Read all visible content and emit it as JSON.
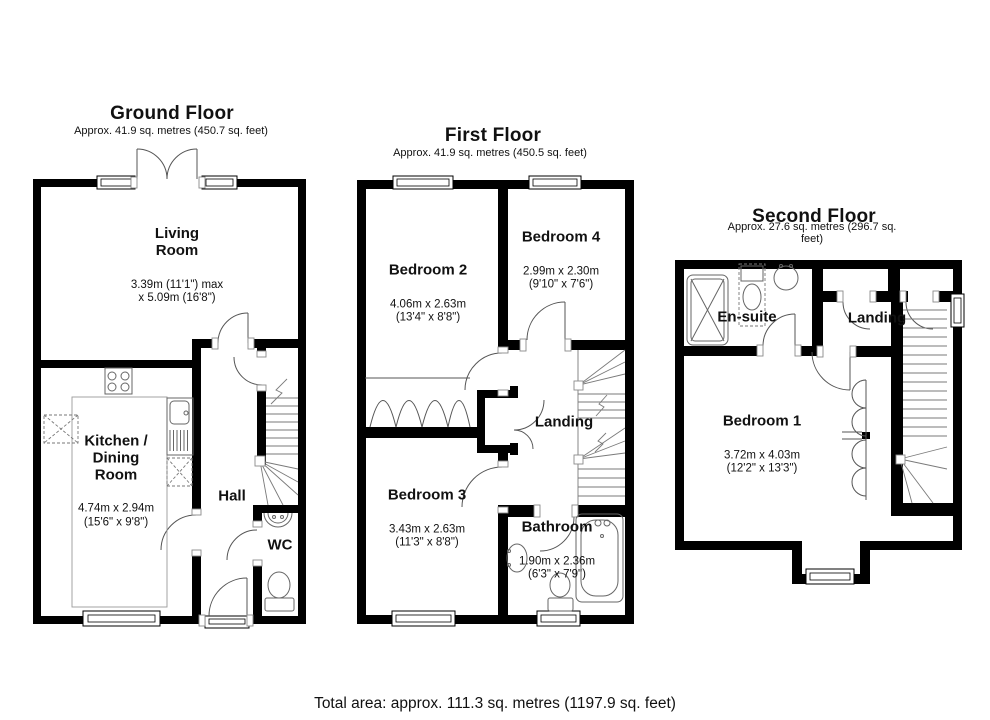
{
  "footer": {
    "total_area": "Total area: approx. 111.3 sq. metres (1197.9 sq. feet)"
  },
  "colors": {
    "wall": "#000000",
    "door_line": "#555555",
    "fixture_line": "#666666",
    "text": "#111111",
    "background": "#ffffff"
  },
  "floors": {
    "ground": {
      "title": "Ground Floor",
      "subtitle": "Approx. 41.9 sq. metres (450.7 sq. feet)",
      "rooms": {
        "living": {
          "name": "Living\nRoom",
          "dims": "3.39m (11'1\") max\nx 5.09m (16'8\")"
        },
        "kitchen": {
          "name": "Kitchen /\nDining\nRoom",
          "dims": "4.74m x 2.94m\n(15'6\" x 9'8\")"
        },
        "hall": {
          "name": "Hall"
        },
        "wc": {
          "name": "WC"
        }
      }
    },
    "first": {
      "title": "First Floor",
      "subtitle": "Approx. 41.9 sq. metres (450.5 sq. feet)",
      "rooms": {
        "bedroom2": {
          "name": "Bedroom 2",
          "dims": "4.06m x 2.63m\n(13'4\" x 8'8\")"
        },
        "bedroom4": {
          "name": "Bedroom 4",
          "dims": "2.99m x 2.30m\n(9'10\" x 7'6\")"
        },
        "bedroom3": {
          "name": "Bedroom 3",
          "dims": "3.43m x 2.63m\n(11'3\" x 8'8\")"
        },
        "bathroom": {
          "name": "Bathroom",
          "dims": "1.90m x 2.36m\n(6'3\" x 7'9\")"
        },
        "landing": {
          "name": "Landing"
        }
      }
    },
    "second": {
      "title": "Second Floor",
      "subtitle": "Approx. 27.6 sq. metres (296.7 sq. feet)",
      "rooms": {
        "bedroom1": {
          "name": "Bedroom 1",
          "dims": "3.72m x 4.03m\n(12'2\" x 13'3\")"
        },
        "ensuite": {
          "name": "En-suite"
        },
        "landing": {
          "name": "Landing"
        }
      }
    }
  }
}
